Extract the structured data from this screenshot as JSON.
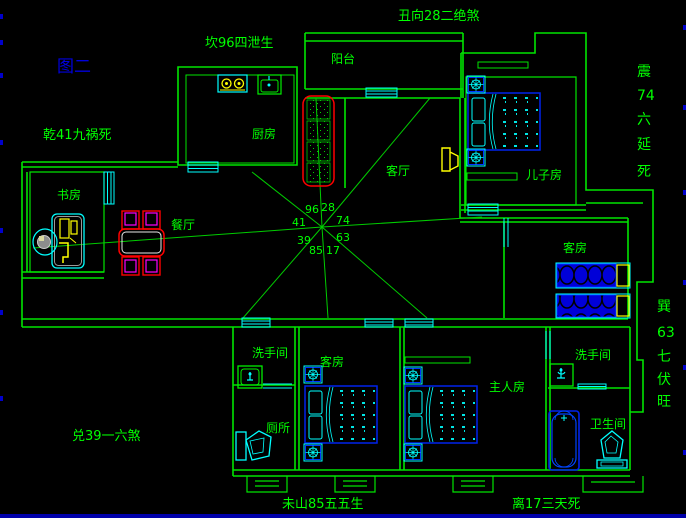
{
  "figure_label": "图二",
  "annotations": {
    "top_left": "坎96四泄生",
    "top_center": "丑向28二绝煞",
    "left": "乾41九祸死",
    "bottom_left": "兑39一六煞",
    "bottom_center": "未山85五五生",
    "bottom_right": "离17三天死",
    "right_upper": {
      "chars": [
        "震",
        "74",
        "六",
        "延",
        "死"
      ]
    },
    "right_lower": {
      "chars": [
        "巽",
        "63",
        "七",
        "伏",
        "旺"
      ]
    }
  },
  "center_numbers": {
    "w": "41",
    "nw": "96",
    "n": "28",
    "ne": "74",
    "sw": "39",
    "s1": "85",
    "s2": "17",
    "se": "63"
  },
  "rooms": {
    "balcony": "阳台",
    "kitchen": "厨房",
    "living_room": "客厅",
    "son_room": "儿子房",
    "study": "书房",
    "dining": "餐厅",
    "guest_room_right": "客房",
    "washroom_left": "洗手间",
    "toilet": "厕所",
    "guest_room_bottom": "客房",
    "master_room": "主人房",
    "washroom_right": "洗手间",
    "bathroom": "卫生间"
  },
  "colors": {
    "background": "#000000",
    "wall": "#00e400",
    "text": "#00ff00",
    "ray": "#00cc00",
    "window_door": "#00ffff",
    "furniture_blue": "#0000ee",
    "furniture_cyan": "#00ffff",
    "accent_red": "#ff0000",
    "accent_yellow": "#ffff00",
    "accent_magenta": "#ff00ff",
    "figure_label_blue": "#0000dd",
    "bottom_bar": "#0000aa"
  }
}
